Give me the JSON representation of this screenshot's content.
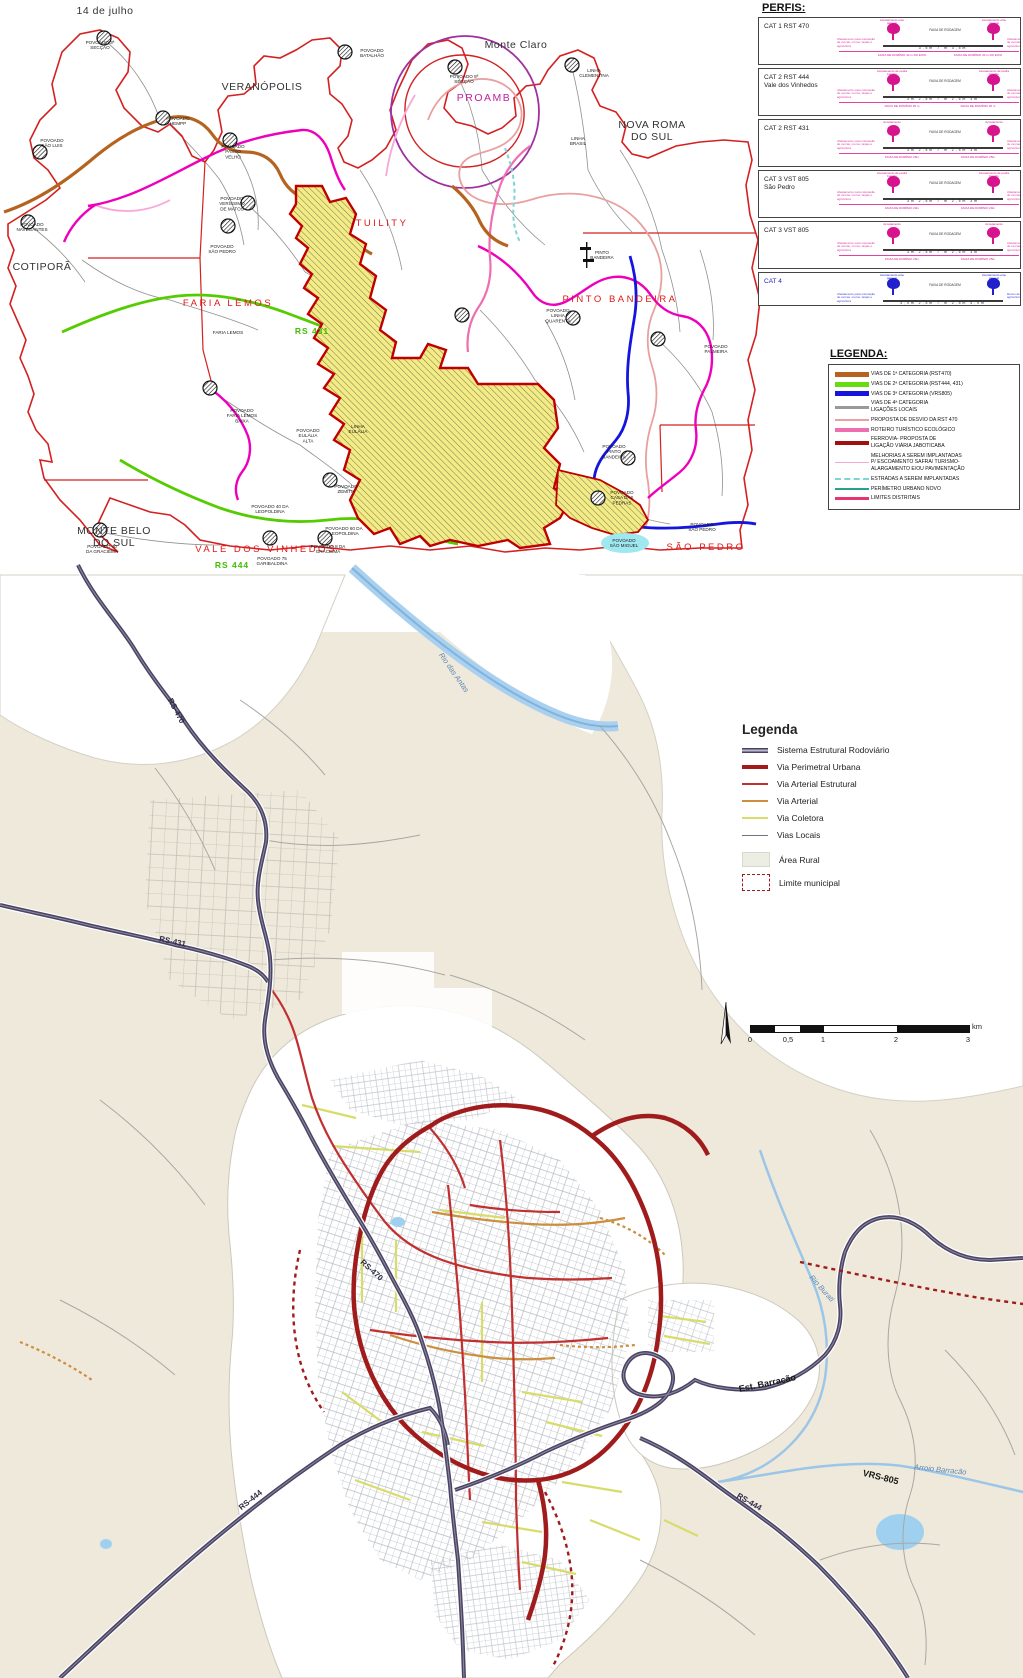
{
  "palette": {
    "boundary_red": "#d42020",
    "urban_outline": "#c00000",
    "urban_fill": "#f3ec86",
    "cat1_orange": "#b4641e",
    "cat2_green": "#55cc00",
    "cat3_blue": "#1515dd",
    "cat4_gray": "#999999",
    "desvio_salmon": "#e8a0a0",
    "roteiro_pink": "#ef6eb0",
    "ferrovia_dark_red": "#a01010",
    "melhorias_pink": "#f7a8d8",
    "estradas_cyan": "#7fd4d4",
    "perimetro_teal": "#2aa190",
    "limites_crimson": "#e8336e",
    "sistema_dark": "#4a4462",
    "perimetral": "#a01c1c",
    "arterial_estrutural": "#c03030",
    "arterial": "#cc8f3f",
    "coletora": "#d8dc6a",
    "locais": "#9aa0a8",
    "beige": "#efe9db",
    "river": "#a9d0ee"
  },
  "top_map": {
    "perfis": {
      "title": "PERFIS:",
      "afastamento": "Afastamento para colocação de cercas, muros, taipas e agricultura",
      "faixa_rodagem": "FAIXA DE RODAGEM",
      "rows": [
        {
          "label": "CAT 1 RST 470",
          "sub": "",
          "shoulder": "Acostamento e/ou passeio",
          "dims": "3,5m   7 m   3,5m",
          "dominio": "FAIXA DE DOMÍNIO 40 m DO EIXO",
          "side": "",
          "color": "#d6148e"
        },
        {
          "label": "CAT 2 RST 444",
          "sub": "Vale dos Vinhedos",
          "shoulder": "Acostamento de pedra basalto",
          "dims": "3m  2,5m  7 m  2,5m  3m",
          "dominio": "FAIXA DE DOMÍNIO 25 m",
          "side": "",
          "color": "#d6148e"
        },
        {
          "label": "CAT 2 RST 431",
          "sub": "",
          "shoulder": "Acostamento",
          "dims": "3m  2,5m  7 m  2,5m  3m",
          "dominio": "FAIXA DE DOMÍNIO 25m",
          "side": "",
          "color": "#d6148e"
        },
        {
          "label": "CAT 3 VST 805",
          "sub": "São Pedro",
          "shoulder": "Acostamento de pedra basalto",
          "dims": "3m  2,5m  7 m  2,5m  3m",
          "dominio": "FAIXA DE DOMÍNIO 20m",
          "side": "",
          "color": "#d6148e"
        },
        {
          "label": "CAT 3 VST 805",
          "sub": "",
          "shoulder": "Acostamento",
          "dims": "3m  2,5m  7 m  2,5m  3m",
          "dominio": "FAIXA DE DOMÍNIO 25m",
          "side": "",
          "color": "#d6148e"
        },
        {
          "label": "CAT 4",
          "sub": "",
          "shoulder": "Acostamento e/ou passeio",
          "dims": "4,0m  2,5m  7 m  2,5m  4,0m",
          "dominio": "",
          "side": "Recuo de jardim e/ou agricultura",
          "color": "#2020cc"
        }
      ]
    },
    "legenda": {
      "title": "LEGENDA:",
      "items": [
        {
          "label": "VIAS DE 1ª CATEGORIA (RST470)",
          "color": "#b4641e",
          "h": 5,
          "dash": false
        },
        {
          "label": "VIAS DE 2ª CATEGORIA (RST444, 431)",
          "color": "#66dd11",
          "h": 5,
          "dash": false
        },
        {
          "label": "VIAS DE 3ª CATEGORIA (VRS805)",
          "color": "#1515dd",
          "h": 5,
          "dash": false
        },
        {
          "label": "VIAS DE 4ª CATEGORIA\nLIGAÇÕES LOCAIS",
          "color": "#999999",
          "h": 3,
          "dash": false
        },
        {
          "label": "PROPOSTA DE DESVIO DA RST 470",
          "color": "#e8a0a0",
          "h": 2,
          "dash": false
        },
        {
          "label": "ROTEIRO TURÍSTICO ECOLÓGICO",
          "color": "#ef6eb0",
          "h": 3.5,
          "dash": false
        },
        {
          "label": "FERROVIA- PROPOSTA DE\nLIGAÇÃO VIÁRIA JABOTICABA",
          "color": "#a01010",
          "h": 3.5,
          "dash": false
        },
        {
          "label": "MELHORIAS A SEREM IMPLANTADAS\nP/ ESCOAMENTO SAFRA/ TURISMO-\nALARGAMENTO E/OU PAVIMENTAÇÃO",
          "color": "#f7a8d8",
          "h": 1.5,
          "dash": false
        },
        {
          "label": "ESTRADAS A SEREM IMPLANTADAS",
          "color": "#7fd4d4",
          "h": 2,
          "dash": true
        },
        {
          "label": "PERÍMETRO URBANO NOVO",
          "color": "#2aa190",
          "h": 2.5,
          "dash": false
        },
        {
          "label": "LIMITES DISTRITAIS",
          "color": "#e8336e",
          "h": 2.5,
          "dash": false
        }
      ]
    },
    "settlement_markers": [
      [
        104,
        38
      ],
      [
        40,
        152
      ],
      [
        163,
        118
      ],
      [
        345,
        52
      ],
      [
        455,
        67
      ],
      [
        572,
        65
      ],
      [
        230,
        140
      ],
      [
        248,
        203
      ],
      [
        228,
        226
      ],
      [
        28,
        222
      ],
      [
        210,
        388
      ],
      [
        573,
        318
      ],
      [
        658,
        339
      ],
      [
        628,
        458
      ],
      [
        598,
        498
      ],
      [
        330,
        480
      ],
      [
        100,
        530
      ],
      [
        270,
        538
      ],
      [
        325,
        538
      ],
      [
        462,
        315
      ]
    ]
  },
  "bottom_map": {
    "legend": {
      "title": "Legenda",
      "items": [
        {
          "label": "Sistema Estrutural Rodoviário",
          "kind": "sistema",
          "color": "#4a4462"
        },
        {
          "label": "Via Perimetral Urbana",
          "kind": "line",
          "color": "#a01c1c",
          "h": 4
        },
        {
          "label": "Via Arterial Estrutural",
          "kind": "line",
          "color": "#c03030",
          "h": 2.5
        },
        {
          "label": "Via Arterial",
          "kind": "line",
          "color": "#cc8f3f",
          "h": 2.5
        },
        {
          "label": "Via Coletora",
          "kind": "line",
          "color": "#d8dc6a",
          "h": 2.5
        },
        {
          "label": "Vias Locais",
          "kind": "line",
          "color": "#70767e",
          "h": 1
        },
        {
          "label": "Área Rural",
          "kind": "area",
          "color": "#eceee4"
        },
        {
          "label": "Limite municipal",
          "kind": "limite",
          "color": "#a01c1c"
        }
      ]
    },
    "scale": {
      "ticks": [
        "0",
        "0,5",
        "1",
        "2",
        "3"
      ],
      "unit": "km"
    }
  },
  "map_labels": [
    {
      "text": "14 de julho",
      "x": 105,
      "y": 14,
      "cls": "muni"
    },
    {
      "text": "POVOADO 3ª\nSECÇÃO",
      "x": 100,
      "y": 44,
      "cls": "tiny"
    },
    {
      "text": "VERANÓPOLIS",
      "x": 262,
      "y": 90,
      "cls": "muni"
    },
    {
      "text": "POVOADO\nSÃO LUIS",
      "x": 52,
      "y": 142,
      "cls": "tiny"
    },
    {
      "text": "POVOADO\nHEMPP",
      "x": 178,
      "y": 120,
      "cls": "tiny"
    },
    {
      "text": "POVOADO\nBATALHÃO",
      "x": 372,
      "y": 52,
      "cls": "tiny"
    },
    {
      "text": "Monte Claro",
      "x": 516,
      "y": 48,
      "cls": "muni"
    },
    {
      "text": "POVOADO 5ª\nSECÇÃO",
      "x": 464,
      "y": 78,
      "cls": "tiny"
    },
    {
      "text": "PROAMB",
      "x": 484,
      "y": 101,
      "cls": "proamb"
    },
    {
      "text": "LINHA\nCLEMENTINA",
      "x": 594,
      "y": 72,
      "cls": "tiny"
    },
    {
      "text": "NOVA ROMA\nDO SUL",
      "x": 652,
      "y": 128,
      "cls": "muni"
    },
    {
      "text": "LINHA\nBRASIL",
      "x": 578,
      "y": 140,
      "cls": "tiny"
    },
    {
      "text": "POVOADO\nPASSO\nVELHO",
      "x": 233,
      "y": 148,
      "cls": "tiny"
    },
    {
      "text": "POVOADO\nNAVEGANTES",
      "x": 32,
      "y": 226,
      "cls": "tiny"
    },
    {
      "text": "COTIPORÃ",
      "x": 42,
      "y": 270,
      "cls": "muni"
    },
    {
      "text": "POVOADO\nVERÍSSIMO\nDE MATOS",
      "x": 232,
      "y": 200,
      "cls": "tiny"
    },
    {
      "text": "POVOADO\nSÃO PEDRO",
      "x": 222,
      "y": 248,
      "cls": "tiny"
    },
    {
      "text": "TUILITY",
      "x": 382,
      "y": 226,
      "cls": "district"
    },
    {
      "text": "FARIA LEMOS",
      "x": 228,
      "y": 306,
      "cls": "district"
    },
    {
      "text": "FARIA LEMOS",
      "x": 228,
      "y": 334,
      "cls": "tiny"
    },
    {
      "text": "RS 431",
      "x": 312,
      "y": 334,
      "cls": "groad"
    },
    {
      "text": "PINTO\nBANDEIRA",
      "x": 602,
      "y": 254,
      "cls": "tiny"
    },
    {
      "text": "PINTO BANDEIRA",
      "x": 620,
      "y": 302,
      "cls": "district"
    },
    {
      "text": "POVOADO\nLINHA\nQUARENTA",
      "x": 558,
      "y": 312,
      "cls": "tiny"
    },
    {
      "text": "POVOADO\nPALMEIRA",
      "x": 716,
      "y": 348,
      "cls": "tiny"
    },
    {
      "text": "POVOADO\nFARIA LEMOS\nBAIXA",
      "x": 242,
      "y": 412,
      "cls": "tiny"
    },
    {
      "text": "POVOADO\nEULÁLIA\nALTA",
      "x": 308,
      "y": 432,
      "cls": "tiny"
    },
    {
      "text": "LINHA\nEULÁLIA",
      "x": 358,
      "y": 428,
      "cls": "tiny"
    },
    {
      "text": "POVOADO\nZEMITH",
      "x": 346,
      "y": 488,
      "cls": "tiny"
    },
    {
      "text": "POVOADO 40 DA\nLEOPOLDINA",
      "x": 270,
      "y": 508,
      "cls": "tiny"
    },
    {
      "text": "POVOADO 60 DA\nLEOPOLDINA",
      "x": 344,
      "y": 530,
      "cls": "tiny"
    },
    {
      "text": "MONTE BELO\nDO SUL",
      "x": 114,
      "y": 534,
      "cls": "muni"
    },
    {
      "text": "VALE DOS VINHEDOS",
      "x": 266,
      "y": 552,
      "cls": "district"
    },
    {
      "text": "POVOADO 40\nDA GRACIEMA",
      "x": 102,
      "y": 548,
      "cls": "tiny"
    },
    {
      "text": "POVOADO 75\nGARIBALDINA",
      "x": 272,
      "y": 560,
      "cls": "tiny"
    },
    {
      "text": "POVOADO 8 DA\nGRACIEMA",
      "x": 328,
      "y": 548,
      "cls": "tiny"
    },
    {
      "text": "RS 444",
      "x": 232,
      "y": 568,
      "cls": "groad"
    },
    {
      "text": "POVOADO\nSÃO MIGUEL",
      "x": 624,
      "y": 542,
      "cls": "tiny"
    },
    {
      "text": "POVOADO\nCASA DAS\nPEDRAS",
      "x": 622,
      "y": 494,
      "cls": "tiny"
    },
    {
      "text": "POVOADO\nSÃO PEDRO",
      "x": 702,
      "y": 526,
      "cls": "tiny"
    },
    {
      "text": "SÃO PEDRO",
      "x": 706,
      "y": 550,
      "cls": "district"
    },
    {
      "text": "POVOADO\nPINTO\nBANDEIRA",
      "x": 614,
      "y": 448,
      "cls": "tiny"
    },
    {
      "text": "RS-470",
      "x": 174,
      "y": 712,
      "cls": "broad",
      "rot": 62
    },
    {
      "text": "RS-431",
      "x": 172,
      "y": 944,
      "cls": "broad",
      "rot": 12
    },
    {
      "text": "RS-470",
      "x": 370,
      "y": 1272,
      "cls": "broad",
      "rot": 42
    },
    {
      "text": "Est. Barracão",
      "x": 768,
      "y": 1386,
      "cls": "broadL",
      "rot": -12
    },
    {
      "text": "VRS-805",
      "x": 880,
      "y": 1480,
      "cls": "broadL",
      "rot": 14
    },
    {
      "text": "RS-444",
      "x": 252,
      "y": 1502,
      "cls": "broad",
      "rot": -38
    },
    {
      "text": "RS-444",
      "x": 748,
      "y": 1504,
      "cls": "broad",
      "rot": 30
    },
    {
      "text": "Rio das Antas",
      "x": 452,
      "y": 674,
      "cls": "river",
      "rot": 55
    },
    {
      "text": "Rio Burati",
      "x": 820,
      "y": 1290,
      "cls": "river",
      "rot": 48
    },
    {
      "text": "Arroio Barracão",
      "x": 940,
      "y": 1472,
      "cls": "river",
      "rot": 6
    }
  ]
}
